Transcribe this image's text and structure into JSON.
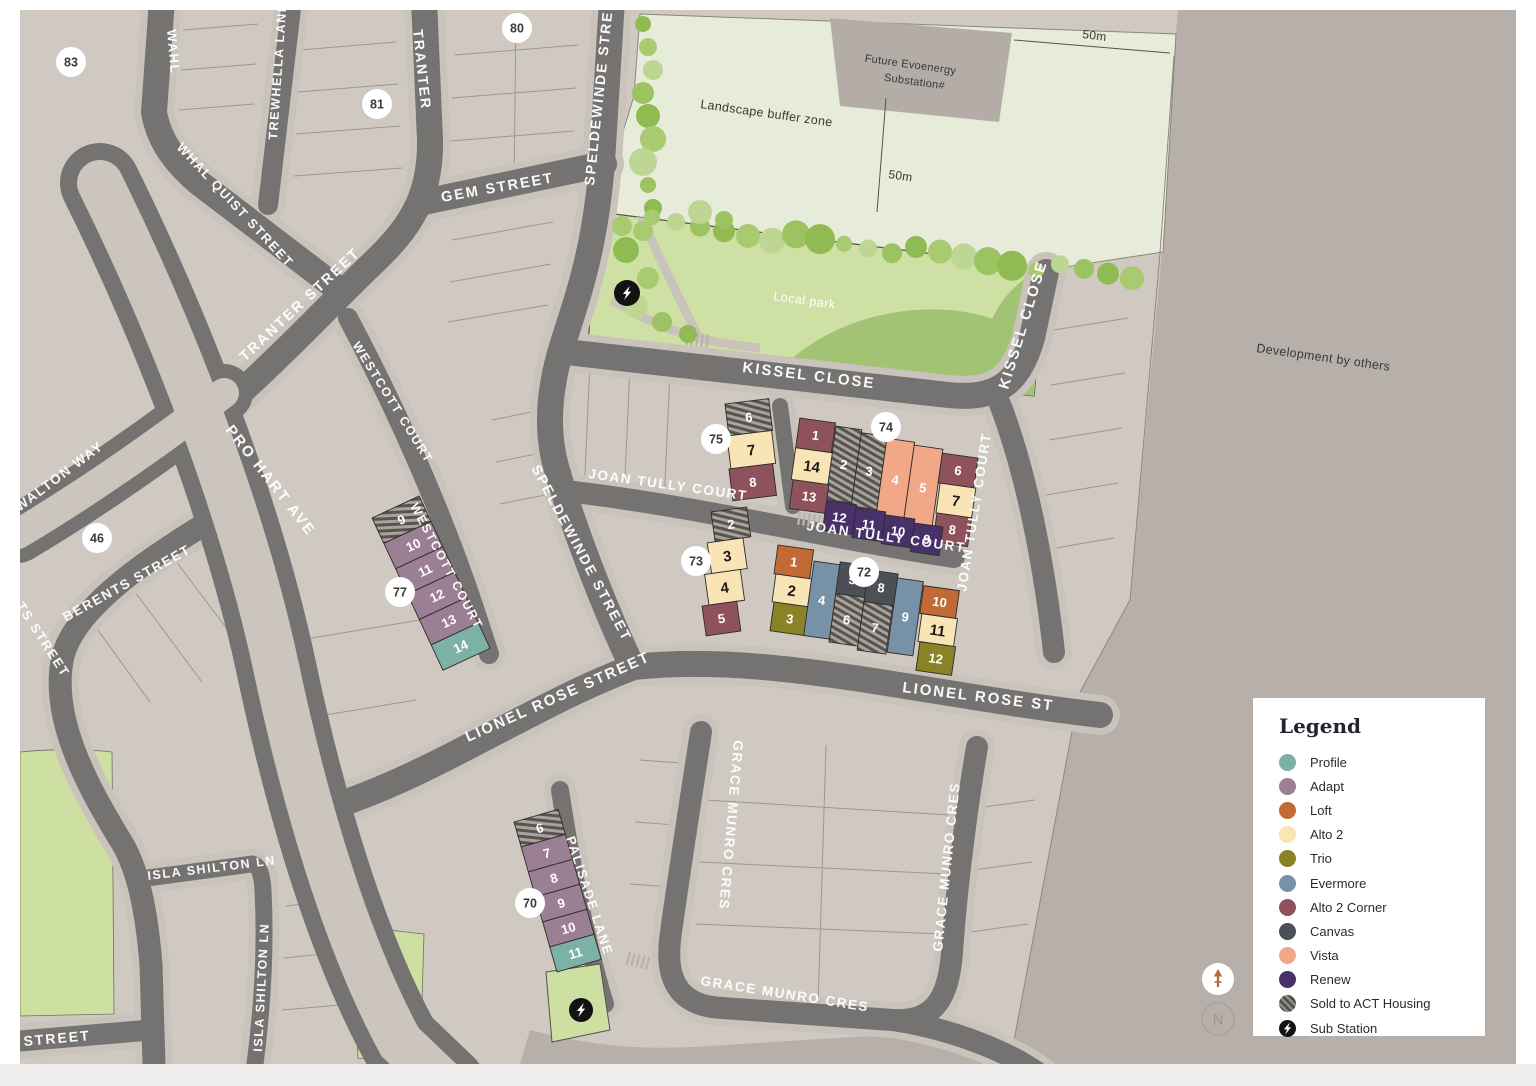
{
  "map": {
    "streets": {
      "wahl": "WAHL",
      "whal_quist": "WHAL QUIST STREET",
      "trewhella": "TREWHELLA LANE",
      "tranter_vertical": "TRANTER",
      "tranter": "TRANTER STREET",
      "gem": "GEM STREET",
      "speldewinde_top": "SPELDEWINDE STREET",
      "speldewinde_mid": "SPELDEWINDE STREET",
      "pro_hart": "PRO HART AVE",
      "b_walton": "B WALTON WAY",
      "berents": "BERENTS STREET",
      "berents_fragment": "TS STREET",
      "street_fragment": "STREET",
      "et_fragment": "ET",
      "westcott_upper": "WESTCOTT COURT",
      "westcott_lower": "WESTCOTT COURT",
      "kissel_h": "KISSEL CLOSE",
      "kissel_v": "KISSEL CLOSE",
      "joan_tully_w": "JOAN TULLY COURT",
      "joan_tully_m": "JOAN TULLY COURT",
      "joan_tully_v": "JOAN TULLY COURT",
      "lionel_rose": "LIONEL ROSE STREET",
      "lionel_rose_e": "LIONEL ROSE ST",
      "grace_munro_l": "GRACE MUNRO CRES",
      "grace_munro_r": "GRACE MUNRO CRES",
      "grace_munro_b": "GRACE MUNRO CRES",
      "palisade": "PALISADE LANE",
      "isla_shilton_h": "ISLA SHILTON LN",
      "isla_shilton_v": "ISLA SHILTON LN"
    },
    "labels": {
      "landscape_buffer": "Landscape buffer zone",
      "substation_line1": "Future Evoenergy",
      "substation_line2": "Substation#",
      "local_park": "Local park",
      "development": "Development by others",
      "dim_50m_top": "50m",
      "dim_50m_mid": "50m"
    },
    "products": {
      "profile": "#7eb1a6",
      "adapt": "#9b7f94",
      "loft": "#c16a36",
      "alto2": "#f8e4b5",
      "trio": "#8a8226",
      "evermore": "#7792a6",
      "alto2corner": "#8e525c",
      "canvas": "#4c5056",
      "vista": "#f2a888",
      "renew": "#483069",
      "substation": "#121212"
    },
    "stage_badges": [
      "83",
      "80",
      "81",
      "46",
      "77",
      "75",
      "74",
      "73",
      "72",
      "70"
    ],
    "clusters": {
      "c75": {
        "lots": [
          {
            "n": "6",
            "p": "act"
          },
          {
            "n": "7",
            "p": "alto2"
          },
          {
            "n": "8",
            "p": "alto2corner"
          }
        ]
      },
      "c74": {
        "lots": [
          {
            "n": "1",
            "p": "alto2corner"
          },
          {
            "n": "2",
            "p": "act"
          },
          {
            "n": "3",
            "p": "act"
          },
          {
            "n": "4",
            "p": "vista"
          },
          {
            "n": "5",
            "p": "vista"
          },
          {
            "n": "6",
            "p": "alto2corner"
          },
          {
            "n": "7",
            "p": "alto2"
          },
          {
            "n": "8",
            "p": "alto2corner"
          },
          {
            "n": "9",
            "p": "renew"
          },
          {
            "n": "10",
            "p": "renew"
          },
          {
            "n": "11",
            "p": "renew"
          },
          {
            "n": "12",
            "p": "renew"
          },
          {
            "n": "13",
            "p": "alto2corner"
          },
          {
            "n": "14",
            "p": "alto2"
          }
        ]
      },
      "c73": {
        "lots": [
          {
            "n": "2",
            "p": "act"
          },
          {
            "n": "3",
            "p": "alto2"
          },
          {
            "n": "4",
            "p": "alto2"
          },
          {
            "n": "5",
            "p": "alto2corner"
          }
        ]
      },
      "c72": {
        "lots": [
          {
            "n": "1",
            "p": "loft"
          },
          {
            "n": "2",
            "p": "alto2"
          },
          {
            "n": "3",
            "p": "trio"
          },
          {
            "n": "4",
            "p": "evermore"
          },
          {
            "n": "5",
            "p": "canvas"
          },
          {
            "n": "6",
            "p": "act"
          },
          {
            "n": "7",
            "p": "act"
          },
          {
            "n": "8",
            "p": "canvas"
          },
          {
            "n": "9",
            "p": "evermore"
          },
          {
            "n": "10",
            "p": "loft"
          },
          {
            "n": "11",
            "p": "alto2"
          },
          {
            "n": "12",
            "p": "trio"
          }
        ]
      },
      "c77": {
        "lots": [
          {
            "n": "9",
            "p": "act"
          },
          {
            "n": "10",
            "p": "adapt"
          },
          {
            "n": "11",
            "p": "adapt"
          },
          {
            "n": "12",
            "p": "adapt"
          },
          {
            "n": "13",
            "p": "adapt"
          },
          {
            "n": "14",
            "p": "profile"
          }
        ]
      },
      "c70": {
        "lots": [
          {
            "n": "6",
            "p": "act"
          },
          {
            "n": "7",
            "p": "adapt"
          },
          {
            "n": "8",
            "p": "adapt"
          },
          {
            "n": "9",
            "p": "adapt"
          },
          {
            "n": "10",
            "p": "adapt"
          },
          {
            "n": "11",
            "p": "profile"
          }
        ]
      }
    }
  },
  "legend": {
    "title": "Legend",
    "items": [
      {
        "label": "Profile",
        "key": "profile"
      },
      {
        "label": "Adapt",
        "key": "adapt"
      },
      {
        "label": "Loft",
        "key": "loft"
      },
      {
        "label": "Alto 2",
        "key": "alto2"
      },
      {
        "label": "Trio",
        "key": "trio"
      },
      {
        "label": "Evermore",
        "key": "evermore"
      },
      {
        "label": "Alto 2 Corner",
        "key": "alto2corner"
      },
      {
        "label": "Canvas",
        "key": "canvas"
      },
      {
        "label": "Vista",
        "key": "vista"
      },
      {
        "label": "Renew",
        "key": "renew"
      },
      {
        "label": "Sold to ACT Housing",
        "key": "act"
      },
      {
        "label": "Sub Station",
        "key": "substation"
      }
    ]
  },
  "compass": {
    "north_letter": "N"
  }
}
